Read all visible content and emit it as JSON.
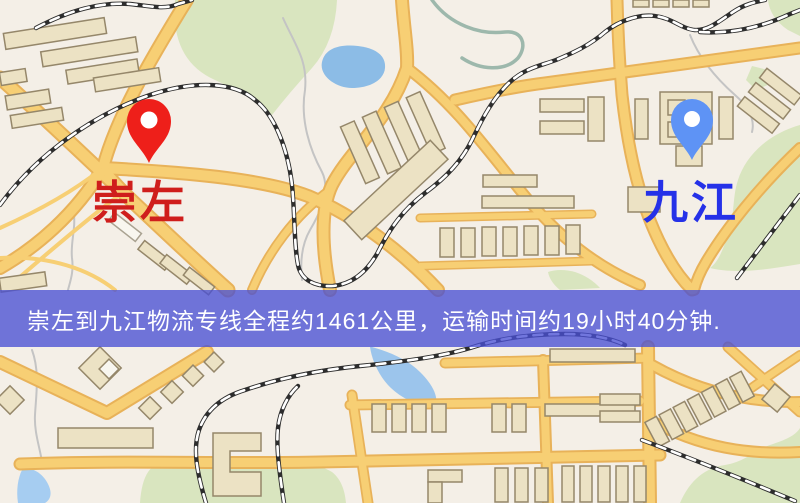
{
  "map": {
    "origin_marker": {
      "icon": "map-pin",
      "label": "崇左",
      "label_color": "#cf1e1c",
      "pin_color": "#ee1f1a"
    },
    "destination_marker": {
      "icon": "map-pin",
      "label": "九江",
      "label_color": "#2531e8",
      "pin_color": "#5e93f5"
    }
  },
  "banner": {
    "text": "崇左到九江物流专线全程约1461公里，运输时间约19小时40分钟.",
    "route": {
      "from": "崇左",
      "to": "九江",
      "distance": "约1461公里",
      "duration": "约19小时40分钟"
    },
    "background_color": "#494fd4",
    "text_color": "#ffffff"
  },
  "palette": {
    "map_background": "#f4efe7",
    "road_fill": "#f7cf74",
    "road_casing": "#e8b259",
    "railway": "#2d2d2d",
    "building_fill": "#ece2c4",
    "building_outline": "#95876a",
    "green_area": "#d9e5bf",
    "water": "#9cc5ec"
  }
}
